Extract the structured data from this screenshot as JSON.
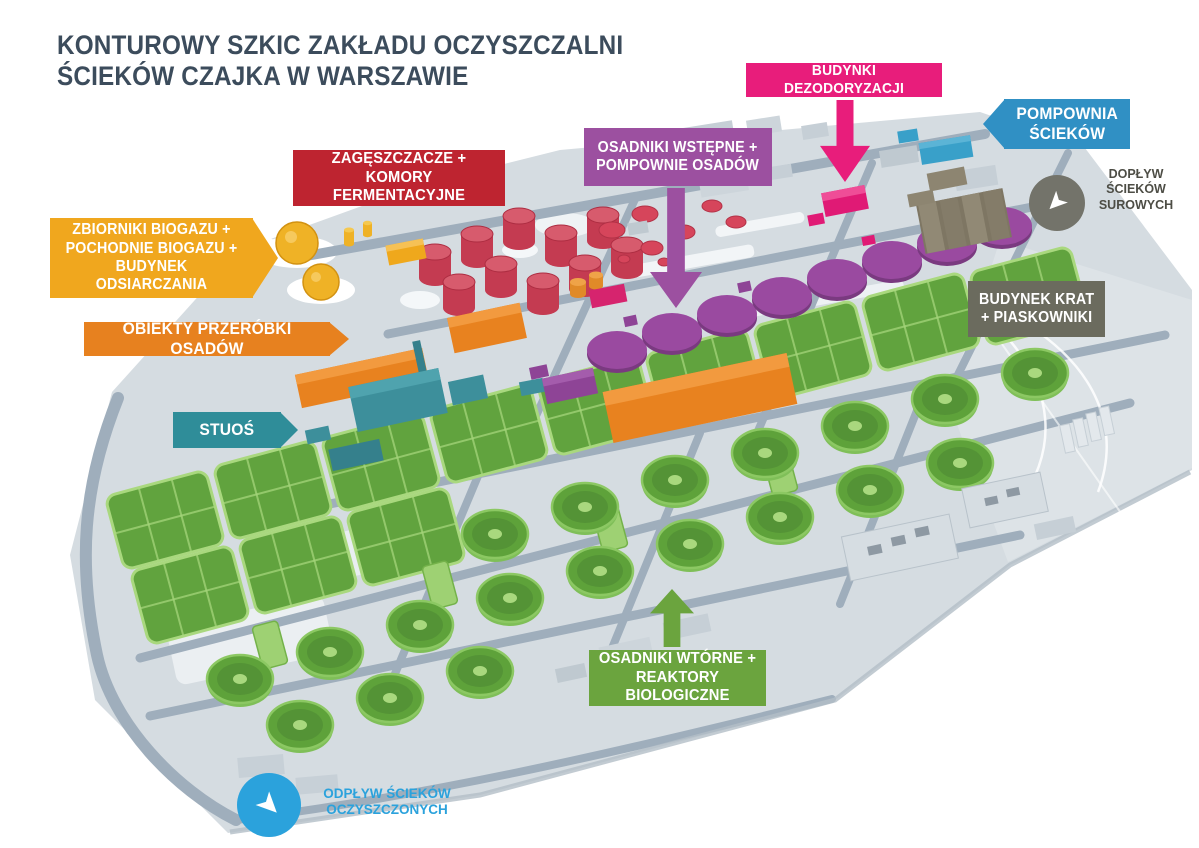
{
  "title": {
    "text": "KONTUROWY SZKIC ZAKŁADU OCZYSZCZALNI\nŚCIEKÓW CZAJKA W WARSZAWIE",
    "color": "#3C4C5C"
  },
  "labels": [
    {
      "id": "budynki-dezodoryzacji",
      "text": "BUDYNKI DEZODORYZACJI",
      "color": "#E81D7B",
      "arrow": "down"
    },
    {
      "id": "pompownia-sciekow",
      "text": "POMPOWNIA\nŚCIEKÓW",
      "color": "#3090C4",
      "arrow": "left"
    },
    {
      "id": "zageszczacze-komory-fermentacyjne",
      "text": "ZAGĘSZCZACZE +\nKOMORY FERMENTACYJNE",
      "color": "#BE2430"
    },
    {
      "id": "osadniki-wstepne-pompownie-osadow",
      "text": "OSADNIKI WSTĘPNE +\nPOMPOWNIE OSADÓW",
      "color": "#9C50A0",
      "arrow": "down"
    },
    {
      "id": "zbiorniki-biogazu",
      "text": "ZBIORNIKI BIOGAZU +\nPOCHODNIE BIOGAZU +\nBUDYNEK ODSIARCZANIA",
      "color": "#F0A71E",
      "arrow": "right"
    },
    {
      "id": "obiekty-przerobki-osadow",
      "text": "OBIEKTY PRZERÓBKI OSADÓW",
      "color": "#E7811F",
      "arrow": "right"
    },
    {
      "id": "budynek-krat-piaskowniki",
      "text": "BUDYNEK KRAT\n+ PIASKOWNIKI",
      "color": "#6B6B5E"
    },
    {
      "id": "stuos",
      "text": "STUOŚ",
      "color": "#2F8D99",
      "arrow": "right"
    },
    {
      "id": "osadniki-wtorne-reaktory",
      "text": "OSADNIKI WTÓRNE +\nREAKTORY BIOLOGICZNE",
      "color": "#6BA43E",
      "arrow": "up"
    }
  ],
  "flow_markers": [
    {
      "id": "doplyw-sciekow-surowych",
      "text": "DOPŁYW\nŚCIEKÓW\nSUROWYCH",
      "icon_color": "#73736A",
      "text_color": "#4D4D45",
      "arrow_direction": "down-left"
    },
    {
      "id": "odplyw-sciekow-oczyszczonych",
      "text": "ODPŁYW ŚCIEKÓW\nOCZYSZCZONYCH",
      "icon_color": "#2BA2DC",
      "text_color": "#2BA2DC",
      "arrow_direction": "down-right"
    }
  ],
  "palette": {
    "ground": "#D5DCE1",
    "roads": "#9FAEBC",
    "bioreactors_green": "#61A33E",
    "primary_tanks_purple": "#9A4AA0",
    "fermentation_red": "#C43B51",
    "biogas_yellow": "#EFB226",
    "sludge_orange": "#E8821F",
    "stuos_teal": "#3D8F9B",
    "krat_khaki": "#837B67",
    "deodorization_pink": "#E01A75",
    "pumping_blue": "#39A0C9"
  }
}
